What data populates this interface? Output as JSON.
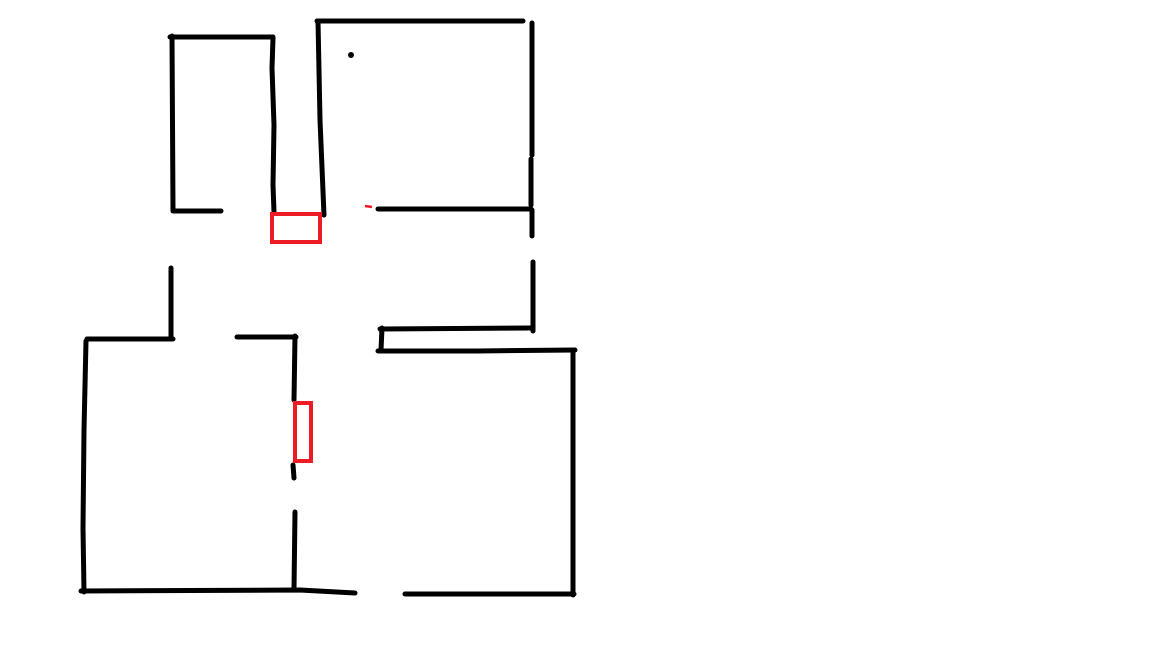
{
  "canvas": {
    "width": 1152,
    "height": 648,
    "background": "#ffffff",
    "description": "hand-drawn floor plan sketch with black wall strokes and red opening markers"
  },
  "colors": {
    "ink": "#000000",
    "marker_red": "#ed1c24"
  },
  "stroke": {
    "wall_width": 5,
    "marker_width": 4,
    "dash_width": 2.5
  },
  "drawing": {
    "wall_strokes": [
      {
        "name": "top-left-room-top-wall",
        "points": [
          [
            170,
            37
          ],
          [
            273,
            37
          ]
        ]
      },
      {
        "name": "top-left-room-left-wall",
        "points": [
          [
            172,
            36
          ],
          [
            173,
            210
          ]
        ]
      },
      {
        "name": "top-left-room-bottom-stub",
        "points": [
          [
            173,
            211
          ],
          [
            221,
            211
          ]
        ]
      },
      {
        "name": "top-left-room-right-wall",
        "points": [
          [
            273,
            38
          ],
          [
            272,
            68
          ],
          [
            274,
            125
          ],
          [
            273,
            185
          ],
          [
            274,
            212
          ]
        ]
      },
      {
        "name": "top-right-room-top-wall",
        "points": [
          [
            317,
            21
          ],
          [
            523,
            21
          ]
        ]
      },
      {
        "name": "top-right-room-left-wall",
        "points": [
          [
            318,
            21
          ],
          [
            320,
            120
          ],
          [
            324,
            215
          ]
        ]
      },
      {
        "name": "top-right-room-right-wall-1",
        "points": [
          [
            532,
            23
          ],
          [
            532,
            155
          ]
        ]
      },
      {
        "name": "top-right-room-right-wall-2",
        "points": [
          [
            531,
            159
          ],
          [
            531,
            205
          ]
        ]
      },
      {
        "name": "top-right-room-right-wall-3",
        "points": [
          [
            532,
            210
          ],
          [
            532,
            236
          ]
        ]
      },
      {
        "name": "top-right-room-bottom-wall",
        "points": [
          [
            378,
            209
          ],
          [
            531,
            209
          ]
        ]
      },
      {
        "name": "right-corridor-wall",
        "points": [
          [
            533,
            262
          ],
          [
            533,
            331
          ]
        ]
      },
      {
        "name": "bottom-right-room-upper-top-wall",
        "points": [
          [
            380,
            329
          ],
          [
            532,
            328
          ]
        ]
      },
      {
        "name": "bottom-right-room-left-stub",
        "points": [
          [
            382,
            328
          ],
          [
            381,
            350
          ]
        ]
      },
      {
        "name": "bottom-right-room-lower-top-wall",
        "points": [
          [
            378,
            351
          ],
          [
            477,
            351
          ],
          [
            575,
            350
          ]
        ]
      },
      {
        "name": "bottom-right-room-right-wall",
        "points": [
          [
            573,
            350
          ],
          [
            573,
            595
          ]
        ]
      },
      {
        "name": "bottom-right-room-bottom-wall",
        "points": [
          [
            405,
            594
          ],
          [
            574,
            594
          ]
        ]
      },
      {
        "name": "bottom-left-room-entry-wall",
        "points": [
          [
            171,
            268
          ],
          [
            171,
            339
          ]
        ]
      },
      {
        "name": "bottom-left-room-top-wall",
        "points": [
          [
            87,
            339
          ],
          [
            173,
            339
          ]
        ]
      },
      {
        "name": "bottom-left-room-left-wall",
        "points": [
          [
            86,
            341
          ],
          [
            84,
            430
          ],
          [
            83,
            528
          ],
          [
            84,
            592
          ]
        ]
      },
      {
        "name": "bottom-left-room-bottom-wall",
        "points": [
          [
            81,
            591
          ],
          [
            300,
            590
          ],
          [
            355,
            593
          ]
        ]
      },
      {
        "name": "bottom-left-room-inner-top-wall",
        "points": [
          [
            237,
            337
          ],
          [
            296,
            337
          ]
        ]
      },
      {
        "name": "inner-partition-upper",
        "points": [
          [
            295,
            336
          ],
          [
            294,
            400
          ]
        ]
      },
      {
        "name": "inner-partition-middle",
        "points": [
          [
            293,
            465
          ],
          [
            294,
            478
          ]
        ]
      },
      {
        "name": "inner-partition-lower",
        "points": [
          [
            295,
            512
          ],
          [
            294,
            589
          ]
        ]
      }
    ],
    "red_rects": [
      {
        "name": "door-marker-horizontal",
        "x": 270,
        "y": 212,
        "w": 52,
        "h": 32
      },
      {
        "name": "door-marker-vertical",
        "x": 293,
        "y": 401,
        "w": 20,
        "h": 62
      }
    ],
    "red_dashes": [
      {
        "name": "red-dash-mark",
        "points": [
          [
            365,
            206
          ],
          [
            372,
            207
          ]
        ]
      }
    ],
    "dots": [
      {
        "name": "pen-dot",
        "x": 351,
        "y": 55,
        "r": 3
      }
    ]
  }
}
